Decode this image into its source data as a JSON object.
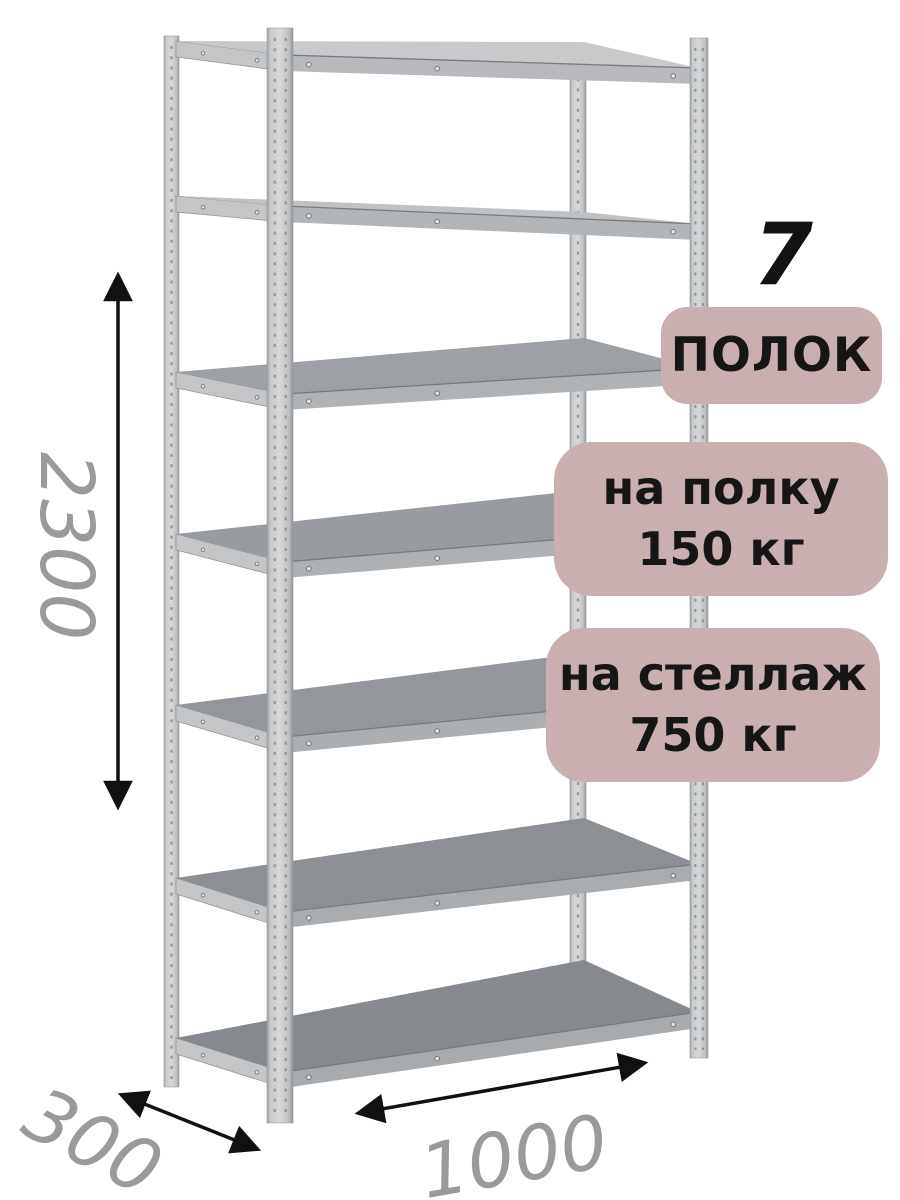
{
  "badges": {
    "shelf_count_value": "7",
    "shelf_count_label": "ПОЛОК",
    "per_shelf_line1": "на полку",
    "per_shelf_line2": "150 кг",
    "per_rack_line1": "на стеллаж",
    "per_rack_line2": "750 кг"
  },
  "dimensions": {
    "height_mm": "2300",
    "depth_mm": "300",
    "width_mm": "1000"
  },
  "figure": {
    "shelf_count": 7,
    "colors": {
      "background": "#ffffff",
      "badge_bg": "#c9afaf",
      "badge_text": "#161616",
      "dimension_text": "#9a9a9a",
      "arrow": "#111111",
      "metal_light": "#d6d8da",
      "metal_dark": "#94979a",
      "shelf_top": "#8f9296",
      "shelf_front": "#aeb1b4"
    }
  }
}
